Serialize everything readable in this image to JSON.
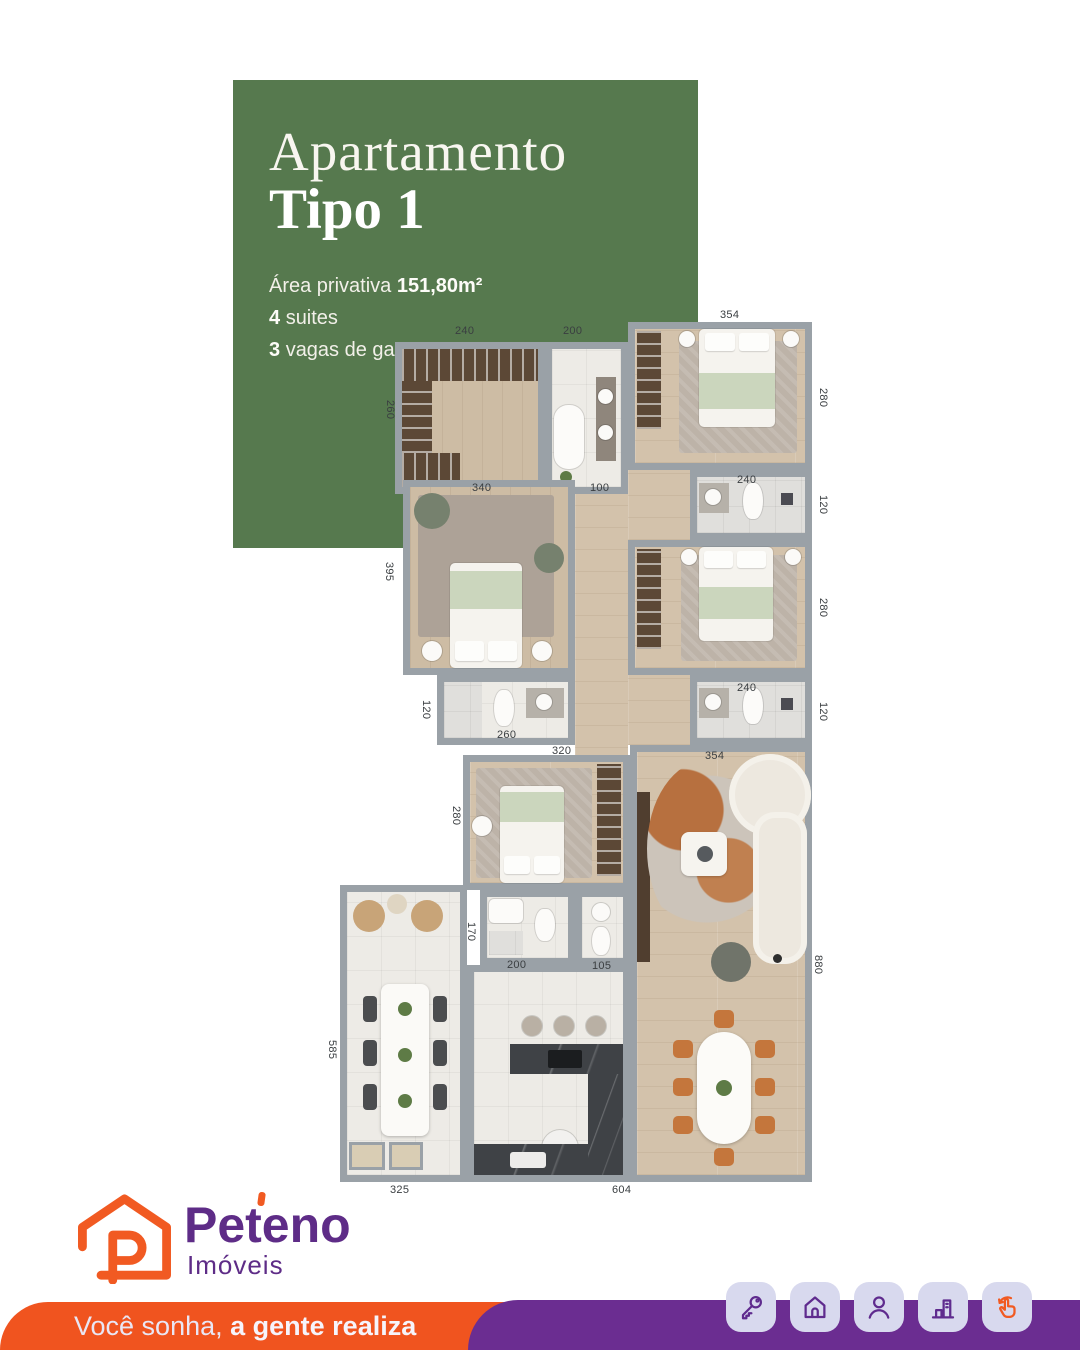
{
  "card": {
    "title_line1": "Apartamento",
    "title_line2": "Tipo 1",
    "area_label": "Área privativa",
    "area_value": "151,80m²",
    "suites_number": "4",
    "suites_text": "suites",
    "garage_number": "3",
    "garage_text": "vagas de garagem"
  },
  "plan": {
    "dims": [
      "240",
      "200",
      "354",
      "260",
      "280",
      "340",
      "100",
      "240",
      "120",
      "395",
      "280",
      "120",
      "260",
      "240",
      "120",
      "320",
      "354",
      "280",
      "170",
      "200",
      "105",
      "585",
      "880",
      "325",
      "604"
    ]
  },
  "logo": {
    "brand": "Peteno",
    "subtitle": "Imóveis"
  },
  "footer": {
    "tagline_regular": "Você sonha,",
    "tagline_bold": "a gente realiza",
    "icons": [
      "key-icon",
      "home-icon",
      "user-icon",
      "building-chart-icon",
      "swipe-hand-icon"
    ]
  },
  "colors": {
    "card_green": "#56794E",
    "brand_orange": "#F15A22",
    "footer_orange": "#F0541F",
    "bar_purple": "#6B2D91",
    "logo_purple": "#5E2C87",
    "icon_chip_bg": "#D8D9EE"
  }
}
